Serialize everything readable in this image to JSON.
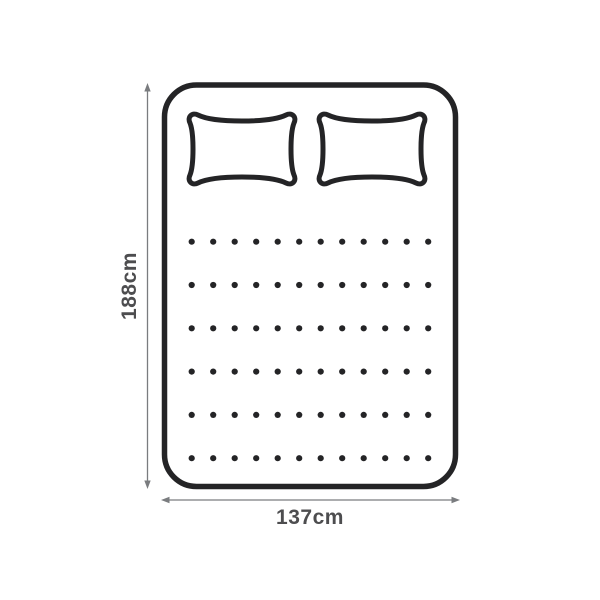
{
  "diagram": {
    "title": "double-mattress-top-view-dimension-diagram",
    "height_label": "188cm",
    "width_label": "137cm",
    "pillow_count": 2,
    "tufting": {
      "rows": 6,
      "cols": 12
    },
    "colors": {
      "outline": "#242426",
      "dimension": "#7a7c7f",
      "label": "#4d4d4f",
      "background": "#ffffff"
    }
  }
}
